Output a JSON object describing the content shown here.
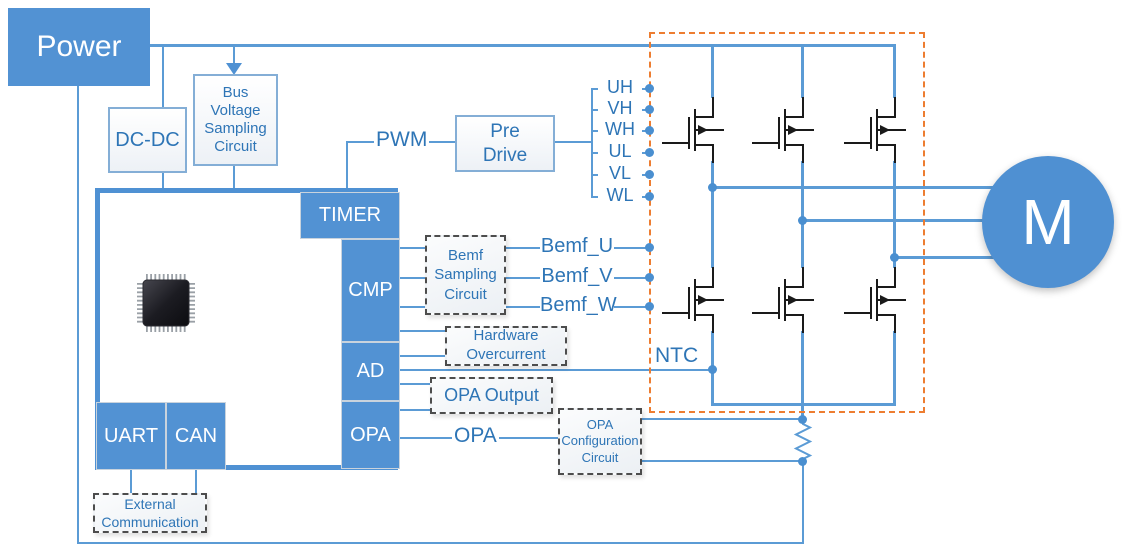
{
  "colors": {
    "accent_blue": "#4f91d3",
    "line_blue": "#5b9bd5",
    "text_blue": "#2e75b6",
    "orange_boundary": "#ed7d31",
    "dashed_border": "#4d4d4d"
  },
  "power": {
    "label": "Power"
  },
  "dcdc": {
    "label": "DC-DC"
  },
  "bus_voltage_sampling": {
    "label": "Bus Voltage Sampling Circuit"
  },
  "mcu": {
    "timer": "TIMER",
    "cmp": "CMP",
    "ad": "AD",
    "opa": "OPA",
    "uart": "UART",
    "can": "CAN"
  },
  "pre_drive": {
    "label": "Pre Drive"
  },
  "signals": {
    "pwm": "PWM",
    "opa": "OPA",
    "ntc": "NTC",
    "gate": [
      "UH",
      "VH",
      "WH",
      "UL",
      "VL",
      "WL"
    ],
    "bemf": [
      "Bemf_U",
      "Bemf_V",
      "Bemf_W"
    ]
  },
  "bemf_sampling": {
    "label": "Bemf Sampling Circuit"
  },
  "hardware_overcurrent": {
    "label": "Hardware Overcurrent"
  },
  "opa_output": {
    "label": "OPA Output"
  },
  "opa_configuration": {
    "label": "OPA Configuration Circuit"
  },
  "external_communication": {
    "label": "External Communication"
  },
  "motor": {
    "label": "M"
  }
}
